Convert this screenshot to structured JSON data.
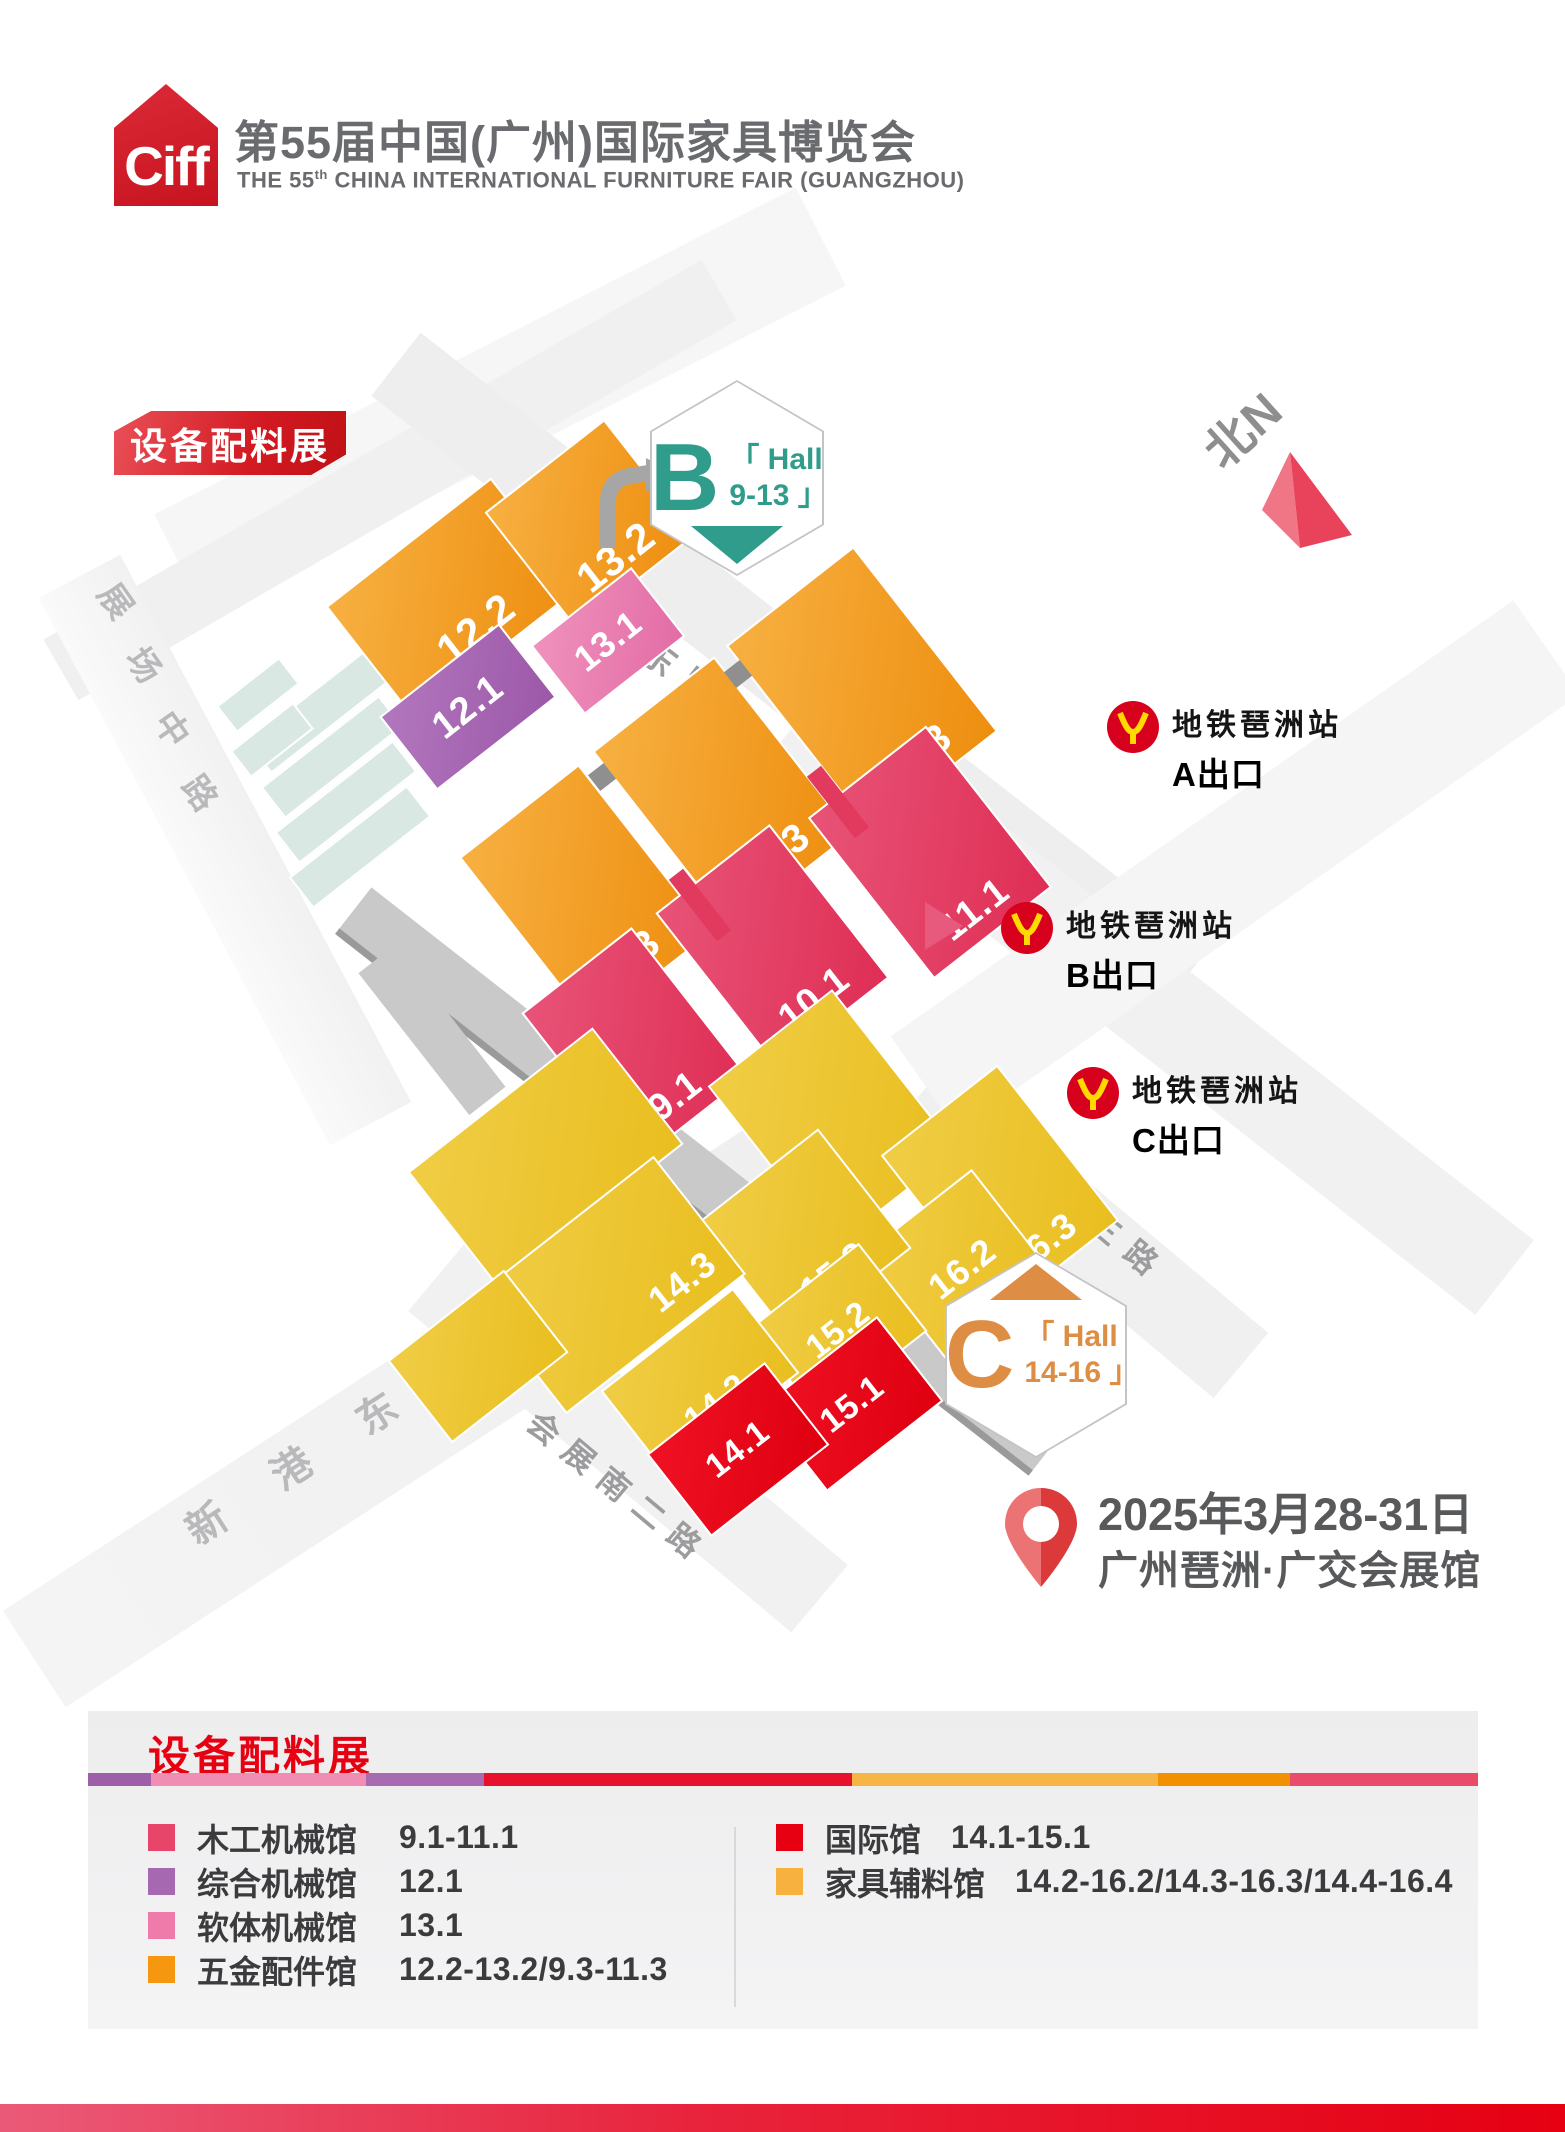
{
  "header": {
    "logo_text": "Ciff",
    "title": "第55届中国(广州)国际家具博览会",
    "subtitle_prefix": "THE 55",
    "subtitle_sup": "th",
    "subtitle_rest": " CHINA INTERNATIONAL FURNITURE FAIR (GUANGZHOU)"
  },
  "map": {
    "badge": "设备配料展",
    "north_label": "北N",
    "hall_badges": [
      {
        "letter": "B",
        "line1": "「 Hall",
        "line2": "9-13 」",
        "color": "#2F9C8C"
      },
      {
        "letter": "C",
        "line1": "「 Hall",
        "line2": "14-16 」",
        "color": "#DE8E44"
      }
    ],
    "streets": [
      {
        "label": "展场东路",
        "x": 580,
        "y": 585,
        "dx": 40,
        "dy": 31,
        "rot": 38,
        "size": 36,
        "color": "#9C9C9E"
      },
      {
        "label": "展场中路",
        "x": 118,
        "y": 592,
        "dx": 28,
        "dy": 64,
        "rot": 55,
        "size": 34,
        "color": "#B9B9BB"
      },
      {
        "label": "新港东路",
        "x": 205,
        "y": 1512,
        "dx": 85,
        "dy": -55,
        "rot": -33,
        "size": 40,
        "color": "#B9B9BB"
      },
      {
        "label": "会展南二路",
        "x": 545,
        "y": 1420,
        "dx": 35,
        "dy": 28,
        "rot": 40,
        "size": 32,
        "color": "#9C9C9E"
      },
      {
        "label": "会展南三路",
        "x": 998,
        "y": 1133,
        "dx": 36,
        "dy": 29,
        "rot": 40,
        "size": 32,
        "color": "#9C9C9E"
      }
    ],
    "hall_colors": {
      "og": [
        "#F7B041",
        "#EE8E0F"
      ],
      "rs": [
        "#E85377",
        "#DF2E55"
      ],
      "pu": [
        "#B277BE",
        "#9C58A8"
      ],
      "pk": [
        "#EF92BC",
        "#E36CA6"
      ],
      "yl": [
        "#F0CD45",
        "#E9BE1F"
      ],
      "rd": [
        "#F01124",
        "#DE000F"
      ]
    },
    "halls": [
      {
        "label": "12.2",
        "color": "og",
        "x": 452,
        "y": 598,
        "w": 210,
        "h": 142,
        "fs": 42,
        "lp": "b"
      },
      {
        "label": "13.2",
        "color": "og",
        "x": 590,
        "y": 524,
        "w": 152,
        "h": 148,
        "fs": 42,
        "lp": "b"
      },
      {
        "label": "12.1",
        "color": "pu",
        "x": 468,
        "y": 707,
        "w": 152,
        "h": 94,
        "fs": 38,
        "lp": "c"
      },
      {
        "label": "13.1",
        "color": "pk",
        "x": 608,
        "y": 641,
        "w": 128,
        "h": 88,
        "fs": 36,
        "lp": "c"
      },
      {
        "label": "9.3",
        "color": "og",
        "x": 585,
        "y": 895,
        "w": 152,
        "h": 215,
        "fs": 40,
        "lp": "b"
      },
      {
        "label": "10.3",
        "color": "og",
        "x": 722,
        "y": 792,
        "w": 155,
        "h": 225,
        "fs": 40,
        "lp": "b"
      },
      {
        "label": "11.3",
        "color": "og",
        "x": 862,
        "y": 688,
        "w": 162,
        "h": 235,
        "fs": 40,
        "lp": "b"
      },
      {
        "label": "9.1",
        "color": "rs",
        "x": 635,
        "y": 1045,
        "w": 140,
        "h": 190,
        "fs": 38,
        "lp": "b"
      },
      {
        "label": "10.1",
        "color": "rs",
        "x": 772,
        "y": 945,
        "w": 145,
        "h": 195,
        "fs": 38,
        "lp": "b"
      },
      {
        "label": "11.1",
        "color": "rs",
        "x": 930,
        "y": 852,
        "w": 150,
        "h": 205,
        "fs": 38,
        "lp": "b"
      },
      {
        "label": "",
        "color": "yl",
        "x": 545,
        "y": 1158,
        "w": 235,
        "h": 148,
        "fs": 34,
        "lp": "c"
      },
      {
        "label": "",
        "color": "yl",
        "x": 833,
        "y": 1118,
        "w": 158,
        "h": 205,
        "fs": 34,
        "lp": "c"
      },
      {
        "label": "16.3",
        "color": "yl",
        "x": 1000,
        "y": 1188,
        "w": 148,
        "h": 198,
        "fs": 36,
        "lp": "b"
      },
      {
        "label": "16.2",
        "color": "yl",
        "x": 962,
        "y": 1268,
        "w": 138,
        "h": 145,
        "fs": 36,
        "lp": "c"
      },
      {
        "label": "15.3",
        "color": "yl",
        "x": 805,
        "y": 1235,
        "w": 152,
        "h": 152,
        "fs": 36,
        "lp": "b"
      },
      {
        "label": "14.3",
        "color": "yl",
        "x": 610,
        "y": 1285,
        "w": 228,
        "h": 150,
        "fs": 36,
        "lp": "br"
      },
      {
        "label": "15.2",
        "color": "yl",
        "x": 838,
        "y": 1330,
        "w": 140,
        "h": 112,
        "fs": 34,
        "lp": "c"
      },
      {
        "label": "14.2",
        "color": "yl",
        "x": 700,
        "y": 1382,
        "w": 168,
        "h": 108,
        "fs": 34,
        "lp": "b"
      },
      {
        "label": "",
        "color": "yl",
        "x": 478,
        "y": 1356,
        "w": 148,
        "h": 105,
        "fs": 34,
        "lp": "c"
      },
      {
        "label": "15.1",
        "color": "rd",
        "x": 852,
        "y": 1404,
        "w": 148,
        "h": 108,
        "fs": 34,
        "lp": "c"
      },
      {
        "label": "14.1",
        "color": "rd",
        "x": 738,
        "y": 1449,
        "w": 150,
        "h": 105,
        "fs": 34,
        "lp": "c"
      }
    ],
    "metro_exits": [
      {
        "station": "地铁琶洲站",
        "exit": "A出口",
        "x": 1106,
        "y": 700
      },
      {
        "station": "地铁琶洲站",
        "exit": "B出口",
        "x": 1000,
        "y": 901
      },
      {
        "station": "地铁琶洲站",
        "exit": "C出口",
        "x": 1066,
        "y": 1066
      }
    ],
    "event": {
      "date": "2025年3月28-31日",
      "venue": "广州琶洲·广交会展馆"
    }
  },
  "legend": {
    "title": "设备配料展",
    "stripe": [
      {
        "color": "#9C5FA8",
        "w": 4.5
      },
      {
        "color": "#F18CB2",
        "w": 15.5
      },
      {
        "color": "#A66BB0",
        "w": 8.5
      },
      {
        "color": "#E8112D",
        "w": 26.5
      },
      {
        "color": "#F7B546",
        "w": 22
      },
      {
        "color": "#F29100",
        "w": 9.5
      },
      {
        "color": "#E84C6A",
        "w": 13.5
      }
    ],
    "columns": {
      "left": [
        {
          "color": "#E8456A",
          "name": "木工机械馆",
          "range": "9.1-11.1"
        },
        {
          "color": "#A668B0",
          "name": "综合机械馆",
          "range": "12.1"
        },
        {
          "color": "#EE7BAA",
          "name": "软体机械馆",
          "range": "13.1"
        },
        {
          "color": "#F5980F",
          "name": "五金配件馆",
          "range": "12.2-13.2/9.3-11.3"
        }
      ],
      "right": [
        {
          "color": "#E60012",
          "name": "国际馆",
          "range": "14.1-15.1"
        },
        {
          "color": "#F7B13F",
          "name": "家具辅料馆",
          "range": "14.2-16.2/14.3-16.3/14.4-16.4"
        }
      ]
    }
  }
}
